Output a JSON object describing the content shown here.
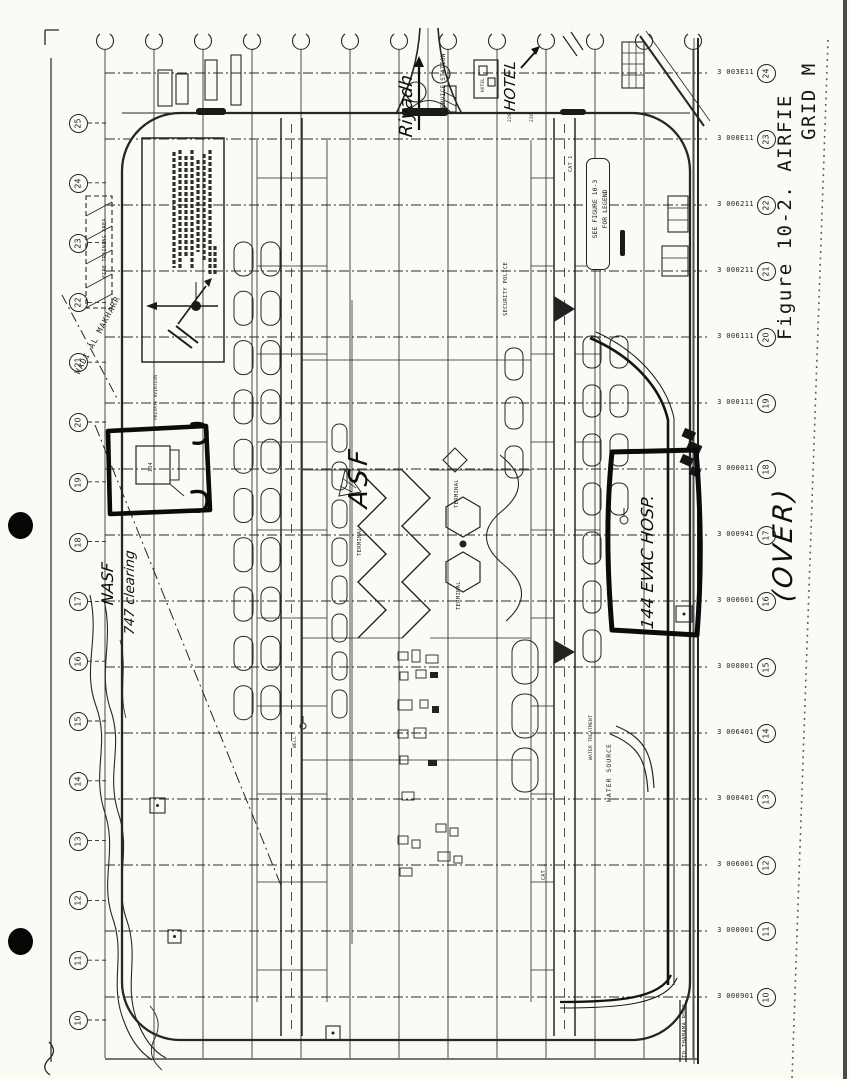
{
  "caption": {
    "line1": "Figure 10-2. AIRFIE",
    "line2": "GRID M"
  },
  "hand": {
    "riyadh": "Riyadh",
    "hotel": "HOTEL",
    "over": "(OVER)",
    "nasf": "NASF",
    "clearing_747": "747 clearing",
    "asf": "ASF",
    "evac_hosp": "144 EVAC HOSP."
  },
  "legend": {
    "line1": "SEE FIGURE 10-3",
    "line2": "FOR LEGEND"
  },
  "labels": {
    "service_station": "SERVICE STATION",
    "security_police": "SECURITY POLICE",
    "terminal_1": "TERMINAL",
    "terminal_2": "TERMINAL",
    "terminal_3": "TERMINAL",
    "water_source": "WATER SOURCE",
    "water_treatment": "WATER TREATMENT",
    "to_road": "TO THAMAMA ROAD",
    "wadi": "WADI AL MAKHARR",
    "fire_training": "FIRE TRAINING AREA",
    "private_aviation": "PRIVATE AVIATION",
    "cat_1a": "CAT 1",
    "cat_1b": "CAT 1",
    "well": "WELL",
    "bldg_134": "134",
    "hotel_small": "HOTEL",
    "num_228": "228",
    "num_226": "226"
  },
  "grid": {
    "top_marker_count": 13,
    "left_circle_numbers": [
      "25",
      "24",
      "23",
      "22",
      "21",
      "20",
      "19",
      "18",
      "17",
      "16",
      "15",
      "14",
      "13",
      "12",
      "11",
      "10"
    ],
    "right_rows": [
      {
        "n": "24",
        "coord": "3 003E11"
      },
      {
        "n": "23",
        "coord": "3 000E11"
      },
      {
        "n": "22",
        "coord": "3 006211"
      },
      {
        "n": "21",
        "coord": "3 000211"
      },
      {
        "n": "20",
        "coord": "3 006111"
      },
      {
        "n": "19",
        "coord": "3 000111"
      },
      {
        "n": "18",
        "coord": "3 000011"
      },
      {
        "n": "17",
        "coord": "3 000941"
      },
      {
        "n": "16",
        "coord": "3 000601"
      },
      {
        "n": "15",
        "coord": "3 000801"
      },
      {
        "n": "14",
        "coord": "3 006401"
      },
      {
        "n": "13",
        "coord": "3 000401"
      },
      {
        "n": "12",
        "coord": "3 006001"
      },
      {
        "n": "11",
        "coord": "3 000001"
      },
      {
        "n": "10",
        "coord": "3 000901"
      }
    ]
  },
  "colors": {
    "ink": "#262626",
    "marker_pen": "#0b0b0b",
    "paper": "#fbfaf5"
  }
}
